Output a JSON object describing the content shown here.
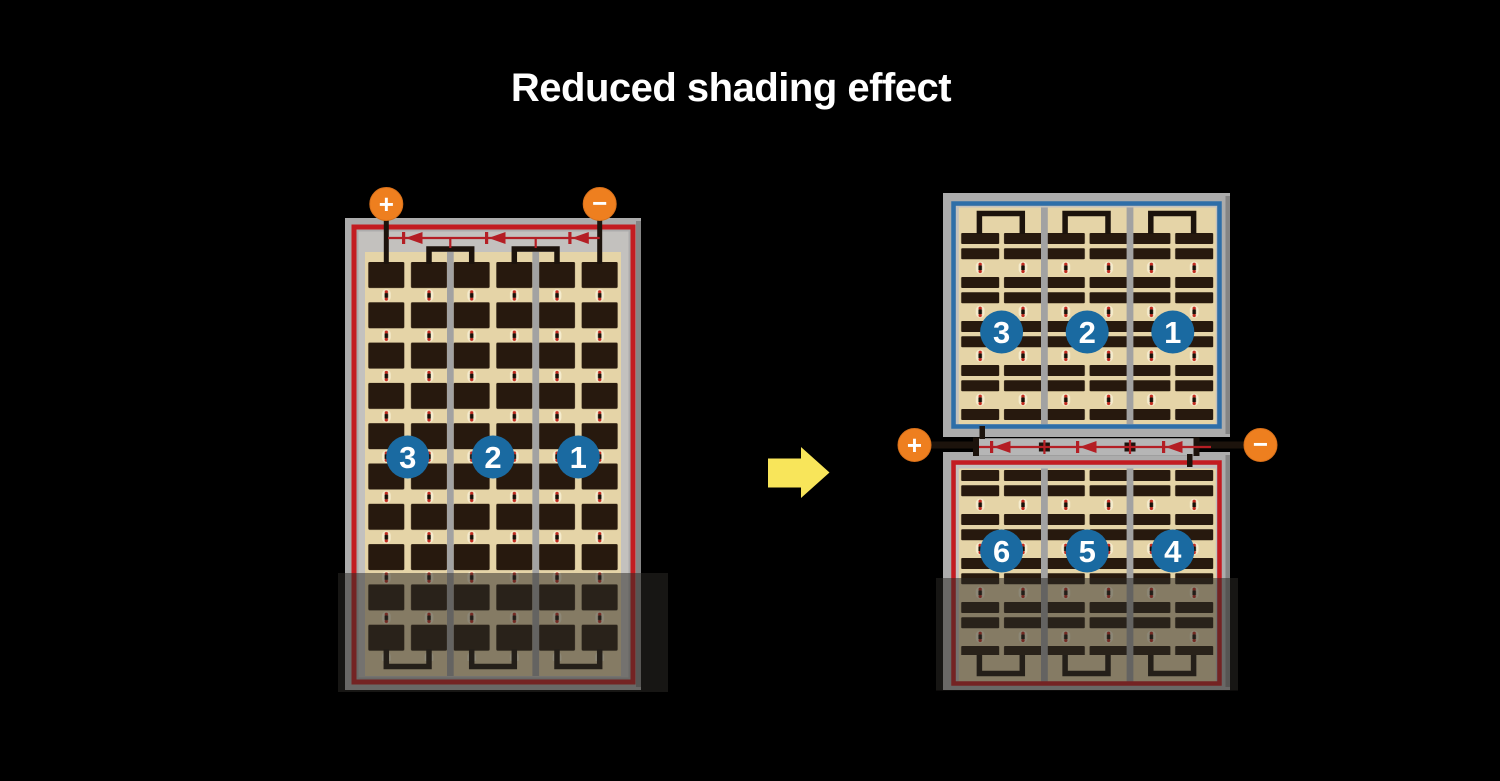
{
  "title": "Reduced shading effect",
  "colors": {
    "background": "#000000",
    "frame_gray": "#acacac",
    "inner_gray": "#c3c1be",
    "tan": "#e5d4a7",
    "gutter_gray": "#a2a2a2",
    "border_red": "#c31c21",
    "border_blue": "#2e6ea8",
    "badge_blue": "#1a6aa1",
    "terminal_orange": "#ee7f1f",
    "terminal_edge": "#d8701a",
    "arrow_yellow": "#f8e55a",
    "diode_red": "#b41e24",
    "wire_black": "#1c130c",
    "channel_gray": "#b6b6b6",
    "shade": "rgba(45,42,38,0.52)",
    "title_white": "#ffffff"
  },
  "left_panel": {
    "terminals": {
      "positive": "+",
      "negative": "−"
    },
    "strings": [
      {
        "label": "3"
      },
      {
        "label": "2"
      },
      {
        "label": "1"
      }
    ]
  },
  "right_top_panel": {
    "strings": [
      {
        "label": "3"
      },
      {
        "label": "2"
      },
      {
        "label": "1"
      }
    ]
  },
  "right_bottom_panel": {
    "terminals": {
      "positive": "+",
      "negative": "−"
    },
    "strings": [
      {
        "label": "6"
      },
      {
        "label": "5"
      },
      {
        "label": "4"
      }
    ]
  }
}
